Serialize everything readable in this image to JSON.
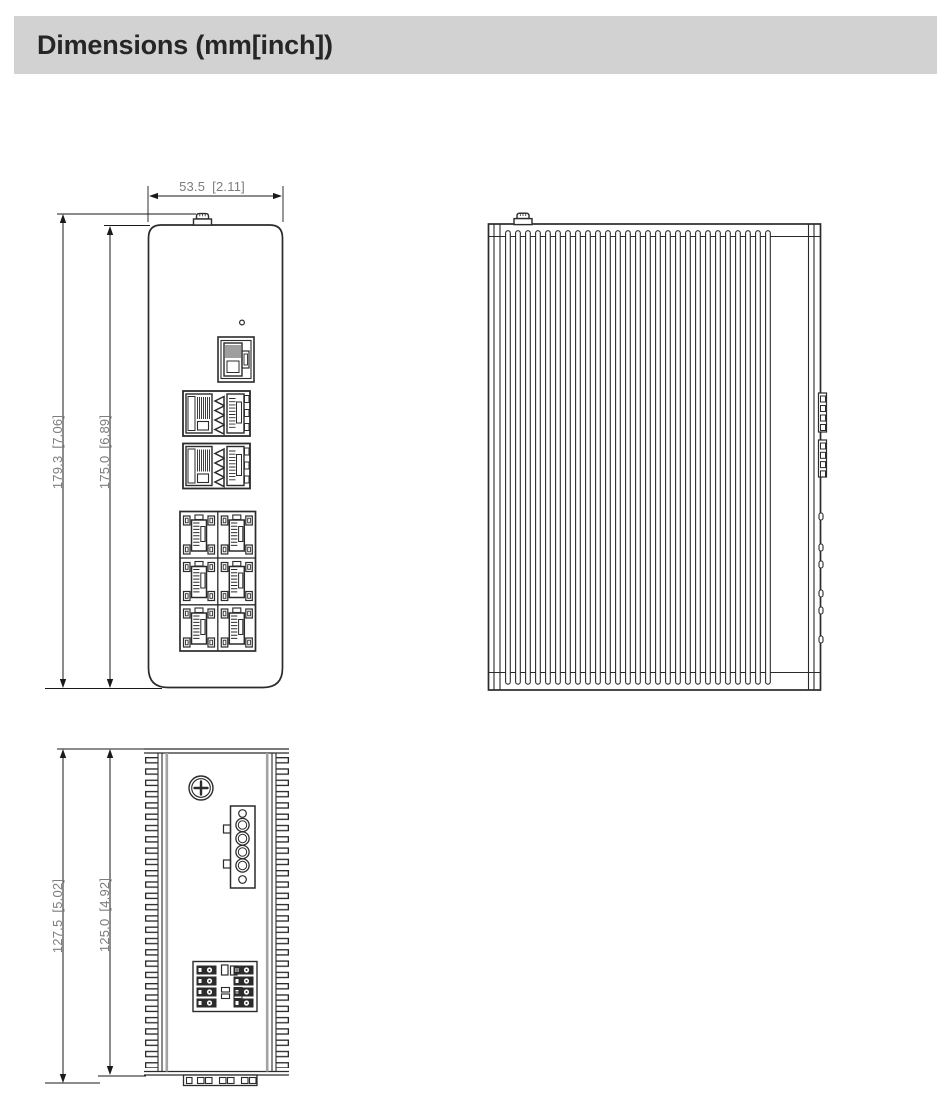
{
  "header": {
    "title": "Dimensions (mm[inch])"
  },
  "views": {
    "front": {
      "width_dim": {
        "mm": "53.5",
        "inch": "[2.11]"
      },
      "overall_height_dim": {
        "mm": "179.3",
        "inch": "[7.06]"
      },
      "body_height_dim": {
        "mm": "175.0",
        "inch": "[6.89]"
      }
    },
    "side": {
      "description": "side view with heatsink fins"
    },
    "top": {
      "overall_depth_dim": {
        "mm": "127.5",
        "inch": "[5.02]"
      },
      "body_depth_dim": {
        "mm": "125.0",
        "inch": "[4.92]"
      }
    }
  },
  "colors": {
    "header_bg": "#d2d2d2",
    "header_text": "#262626",
    "outline": "#2b2b2b",
    "dim_line": "#1a1a1a",
    "dim_text": "#7d7d7d"
  }
}
